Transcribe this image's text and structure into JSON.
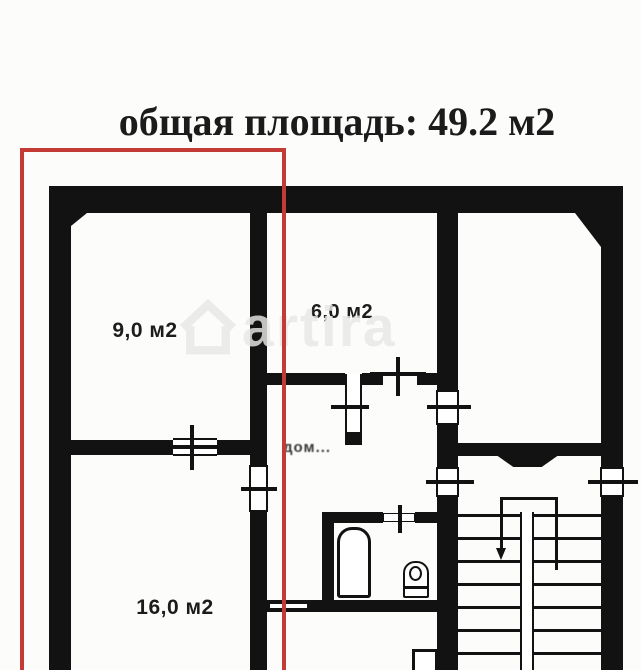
{
  "title": "общая площадь: 49.2 м2",
  "rooms": [
    {
      "id": "room-9",
      "area_label": "9,0 м2"
    },
    {
      "id": "room-6",
      "area_label": "6,0 м2"
    },
    {
      "id": "room-16",
      "area_label": "16,0 м2"
    }
  ],
  "watermark": {
    "brand": "artira",
    "fragment": "дом..."
  },
  "highlight_color": "#c43a35",
  "colors": {
    "wall": "#121212",
    "background": "#fcfcfb",
    "title_text": "#1b1b1b",
    "watermark_light": "#e8e8e6",
    "watermark_dark": "#3a3a3a"
  }
}
